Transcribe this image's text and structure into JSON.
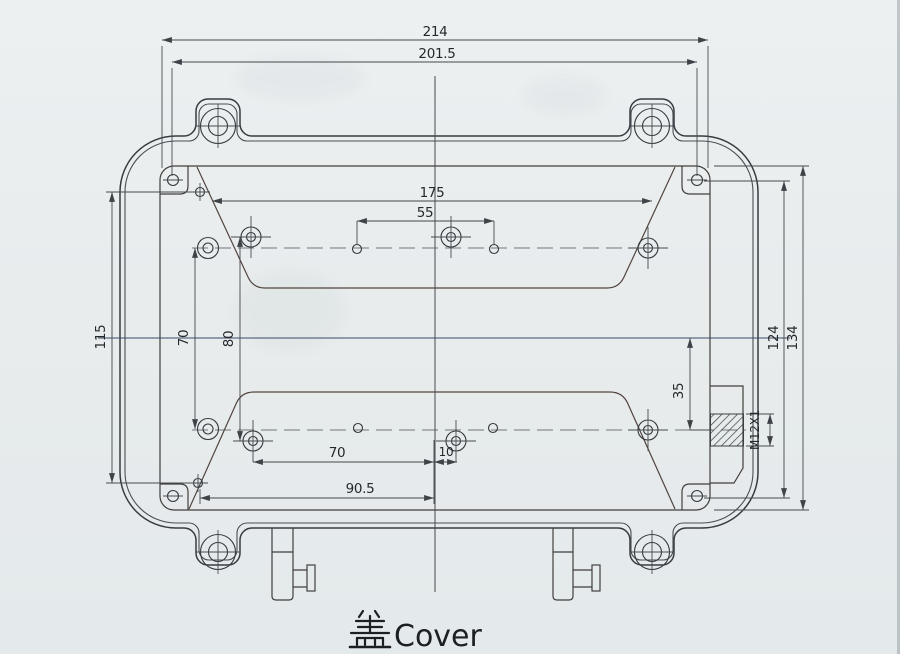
{
  "drawing": {
    "title": {
      "full": "盖Cover",
      "cn": "盖",
      "en": "Cover"
    },
    "dimensions": {
      "overall_width": "214",
      "inner_width": "201.5",
      "left_height": "115",
      "boss_top_width": "175",
      "top_hole_span": "55",
      "vertical_pitch": "70",
      "cross_hole_pitch": "80",
      "bottom_hole_span": "70",
      "bottom_offset": "10",
      "bottom_span": "90.5",
      "right_hole_height": "124",
      "right_cavity_height": "134",
      "thread_offset": "35",
      "thread_spec": "M12X1"
    }
  },
  "colors": {
    "paper": "#e8eced",
    "line": "#383c40",
    "dimension_text": "#26292c",
    "centerline_h": "#3d4a66",
    "band_line": "#524540"
  }
}
